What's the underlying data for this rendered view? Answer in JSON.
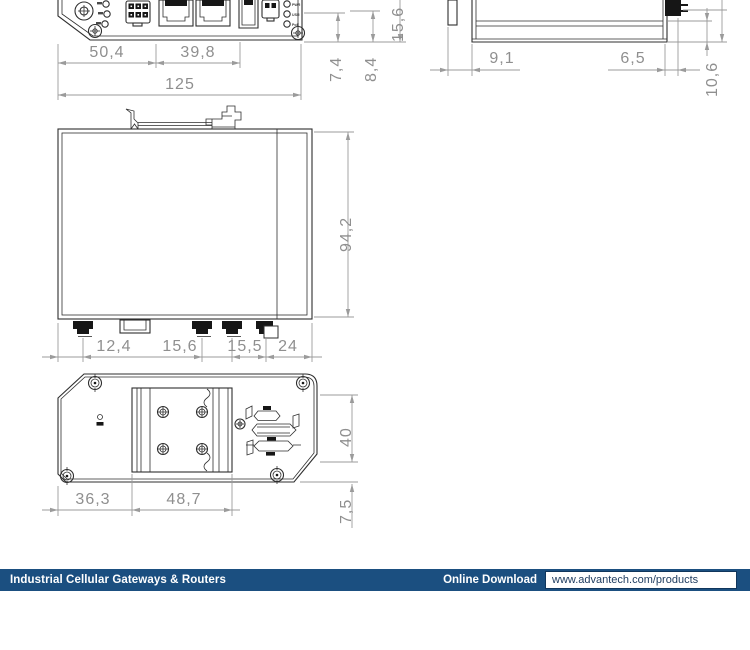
{
  "drawing": {
    "line_color": "#2f2f2f",
    "dim_color": "#9b9b9b",
    "dim_text_color": "#8f8f8f",
    "background": "#ffffff"
  },
  "front_view": {
    "dims": {
      "d_left": "50,4",
      "d_mid": "39,8",
      "d_total": "125",
      "d_v1": "7,4",
      "d_v2": "8,4",
      "d_v3": "15,6"
    },
    "led_labels": [
      "PWR",
      "USR",
      "PoE"
    ]
  },
  "side_view": {
    "dims": {
      "d_clip": "9,1",
      "d_right": "6,5",
      "d_height": "10,6"
    }
  },
  "top_view": {
    "dims": {
      "d_depth": "94,2",
      "d_c1": "12,4",
      "d_c2": "15,6",
      "d_c3": "15,5",
      "d_c4": "24"
    }
  },
  "bottom_view": {
    "dims": {
      "d_left": "36,3",
      "d_din_w": "48,7",
      "d_din_h": "40",
      "d_edge": "7,5"
    }
  },
  "footer": {
    "category_label": "Industrial Cellular Gateways & Routers",
    "download_label": "Online Download",
    "url": "www.advantech.com/products",
    "bar_color": "#1b4f80"
  }
}
